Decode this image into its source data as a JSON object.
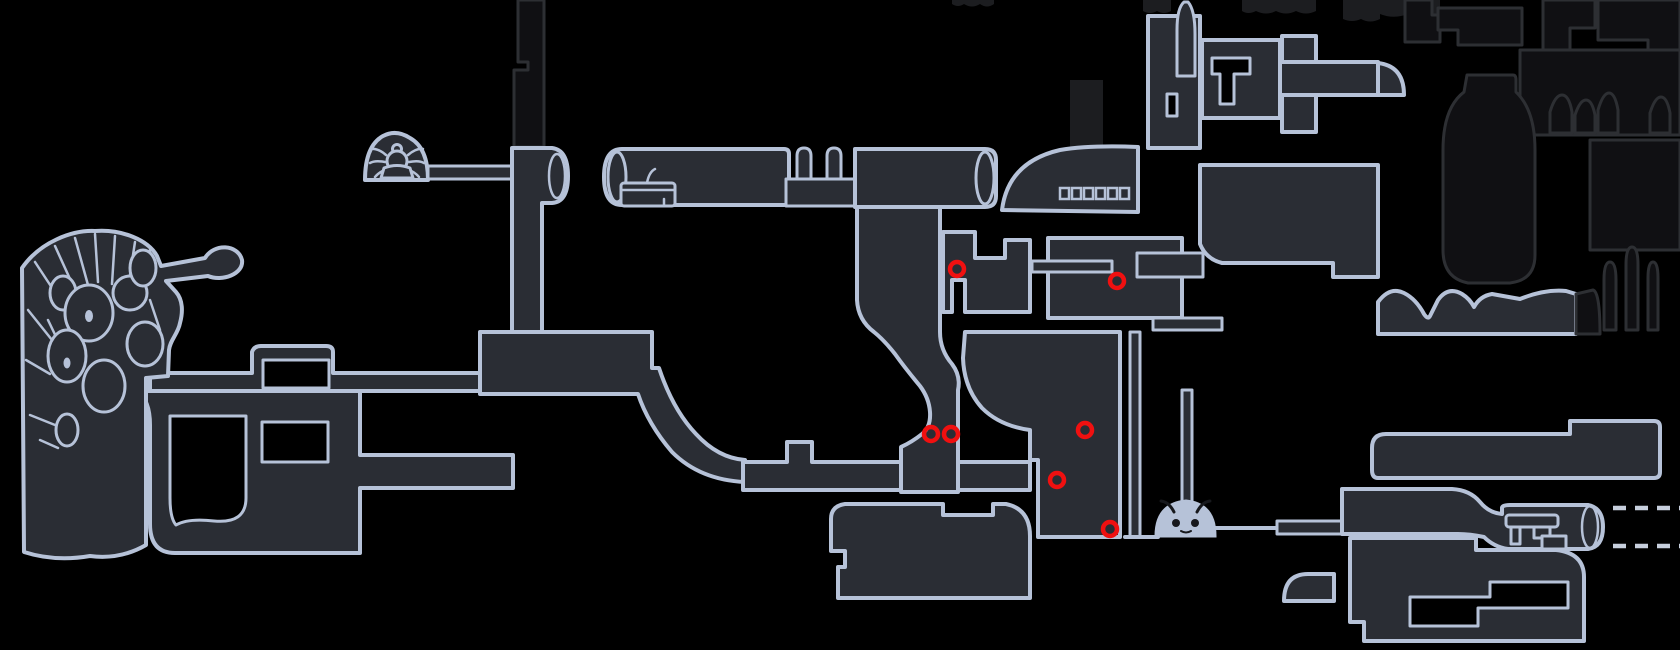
{
  "map": {
    "title": "area-map",
    "colors": {
      "background": "#000000",
      "room_fill": "#2a2d34",
      "room_stroke": "#b6c2d8",
      "unexplored_fill": "#101013",
      "unexplored_stroke": "#2d2f33",
      "undiscovered_fill": "#1c1d20",
      "marker": "#f01010",
      "icon_dark": "#17181c",
      "dash": "#c7cfdd"
    },
    "markers": [
      {
        "x": 957,
        "y": 269
      },
      {
        "x": 1117,
        "y": 281
      },
      {
        "x": 931,
        "y": 434
      },
      {
        "x": 951,
        "y": 434
      },
      {
        "x": 1085,
        "y": 430
      },
      {
        "x": 1057,
        "y": 480
      },
      {
        "x": 1110,
        "y": 529
      }
    ],
    "marker_style": {
      "radius": 7,
      "stroke_width": 4.5
    },
    "dashed_passages": [
      {
        "x1": 1613,
        "y1": 508,
        "x2": 1680,
        "y2": 508
      },
      {
        "x1": 1613,
        "y1": 546,
        "x2": 1680,
        "y2": 546
      }
    ],
    "dash_style": {
      "width": 4.5,
      "dash": "13 9"
    },
    "bridge_teeth": {
      "x": 1060,
      "y": 188,
      "count": 6,
      "tooth_width": 9,
      "tooth_height": 11,
      "gap": 3
    },
    "icons": [
      {
        "name": "spider-icon",
        "x": 397,
        "y": 160
      },
      {
        "name": "tram-icon",
        "x": 648,
        "y": 194
      },
      {
        "name": "stag-face-icon",
        "x": 1186,
        "y": 520
      },
      {
        "name": "bench-icon",
        "x": 1532,
        "y": 530
      },
      {
        "name": "web-nest-icon",
        "x": 95,
        "y": 330
      }
    ]
  }
}
